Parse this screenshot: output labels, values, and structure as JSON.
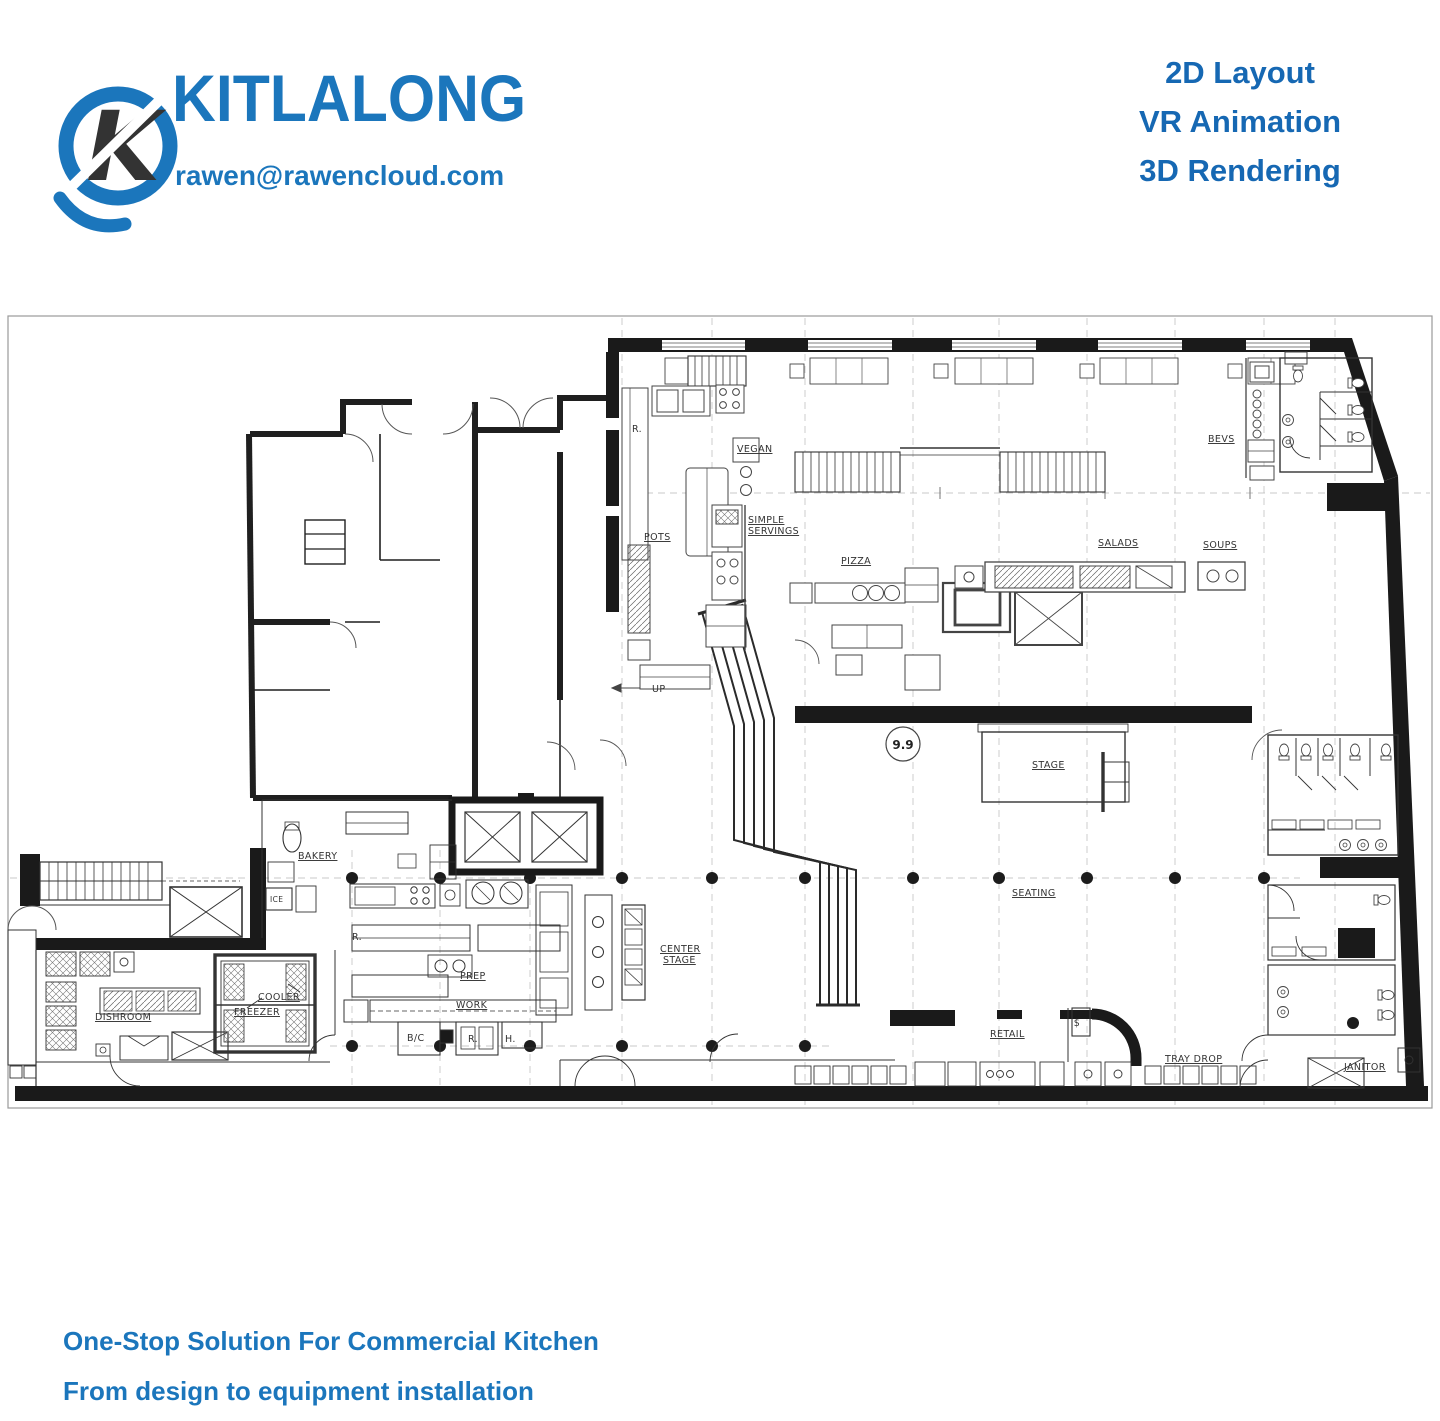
{
  "brand": {
    "name": "KITLALONG",
    "email": "rawen@rawencloud.com",
    "accent_color": "#1b76bc"
  },
  "services": [
    "2D Layout",
    "VR Animation",
    "3D Rendering"
  ],
  "footer": {
    "line1": "One-Stop Solution For Commercial Kitchen",
    "line2": "From design to equipment installation"
  },
  "floorplan": {
    "grid_bubble": "9.9",
    "labels": {
      "vegan": "VEGAN",
      "simple_line1": "SIMPLE",
      "simple_line2": "SERVINGS",
      "pots": "POTS",
      "pizza": "PIZZA",
      "salads": "SALADS",
      "soups": "SOUPS",
      "bevs": "BEVS",
      "up": "UP",
      "stage": "STAGE",
      "seating": "SEATING",
      "center_line1": "CENTER",
      "center_line2": "STAGE",
      "bakery": "BAKERY",
      "ice": "ICE",
      "dishroom": "DISHROOM",
      "cooler": "COOLER",
      "freezer": "FREEZER",
      "r": "R.",
      "prep": "PREP",
      "work": "WORK",
      "bc": "B/C",
      "h": "H.",
      "retail": "RETAIL",
      "cash": "$",
      "tray_drop": "TRAY DROP",
      "janitor": "JANITOR"
    }
  }
}
